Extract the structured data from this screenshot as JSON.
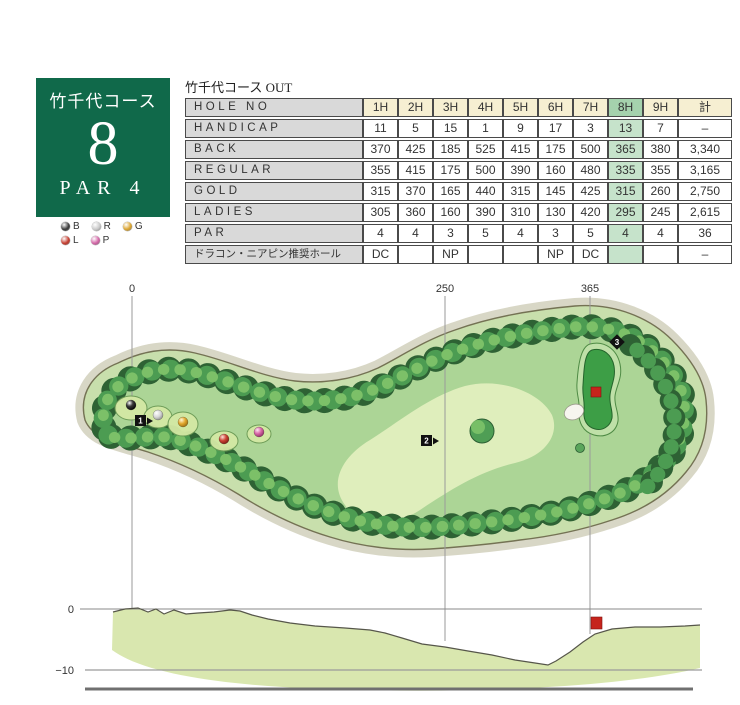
{
  "hole_card": {
    "course_name": "竹千代コース",
    "hole_number": "8",
    "par": "PAR 4",
    "bg_color": "#10694a"
  },
  "tee_legend": {
    "rows": [
      [
        {
          "label": "B",
          "color": "#3a3a3a"
        },
        {
          "label": "R",
          "color": "#c9c9c9"
        },
        {
          "label": "G",
          "color": "#dba42e"
        }
      ],
      [
        {
          "label": "L",
          "color": "#c43a2c"
        },
        {
          "label": "P",
          "color": "#d263a5"
        }
      ]
    ]
  },
  "scorecard": {
    "title": "竹千代コース OUT",
    "header_label": "HOLE NO",
    "columns": [
      "1H",
      "2H",
      "3H",
      "4H",
      "5H",
      "6H",
      "7H",
      "8H",
      "9H",
      "計"
    ],
    "highlight_column": "8H",
    "header_bg": "#f6efd2",
    "highlight_header_bg": "#a5d2ad",
    "highlight_cell_bg": "#c6e3cb",
    "label_bg": "#d9d9d9",
    "rows": [
      {
        "label": "HANDICAP",
        "values": [
          "11",
          "5",
          "15",
          "1",
          "9",
          "17",
          "3",
          "13",
          "7",
          "–"
        ]
      },
      {
        "label": "BACK",
        "values": [
          "370",
          "425",
          "185",
          "525",
          "415",
          "175",
          "500",
          "365",
          "380",
          "3,340"
        ]
      },
      {
        "label": "REGULAR",
        "values": [
          "355",
          "415",
          "175",
          "500",
          "390",
          "160",
          "480",
          "335",
          "355",
          "3,165"
        ]
      },
      {
        "label": "GOLD",
        "values": [
          "315",
          "370",
          "165",
          "440",
          "315",
          "145",
          "425",
          "315",
          "260",
          "2,750"
        ]
      },
      {
        "label": "LADIES",
        "values": [
          "305",
          "360",
          "160",
          "390",
          "310",
          "130",
          "420",
          "295",
          "245",
          "2,615"
        ]
      },
      {
        "label": "PAR",
        "values": [
          "4",
          "4",
          "3",
          "5",
          "4",
          "3",
          "5",
          "4",
          "4",
          "36"
        ]
      },
      {
        "label": "ドラコン・ニアピン推奨ホール",
        "jp": true,
        "values": [
          "DC",
          "",
          "NP",
          "",
          "",
          "NP",
          "DC",
          "",
          "",
          "–"
        ]
      }
    ]
  },
  "map": {
    "distance_markers": [
      {
        "label": "0"
      },
      {
        "label": "250"
      },
      {
        "label": "365"
      }
    ],
    "shot_markers": [
      {
        "label": "1"
      },
      {
        "label": "2"
      },
      {
        "label": "3"
      }
    ],
    "pin_color": "#c6241c",
    "elevation": {
      "zero_label": "0",
      "minus_label": "−10"
    }
  }
}
